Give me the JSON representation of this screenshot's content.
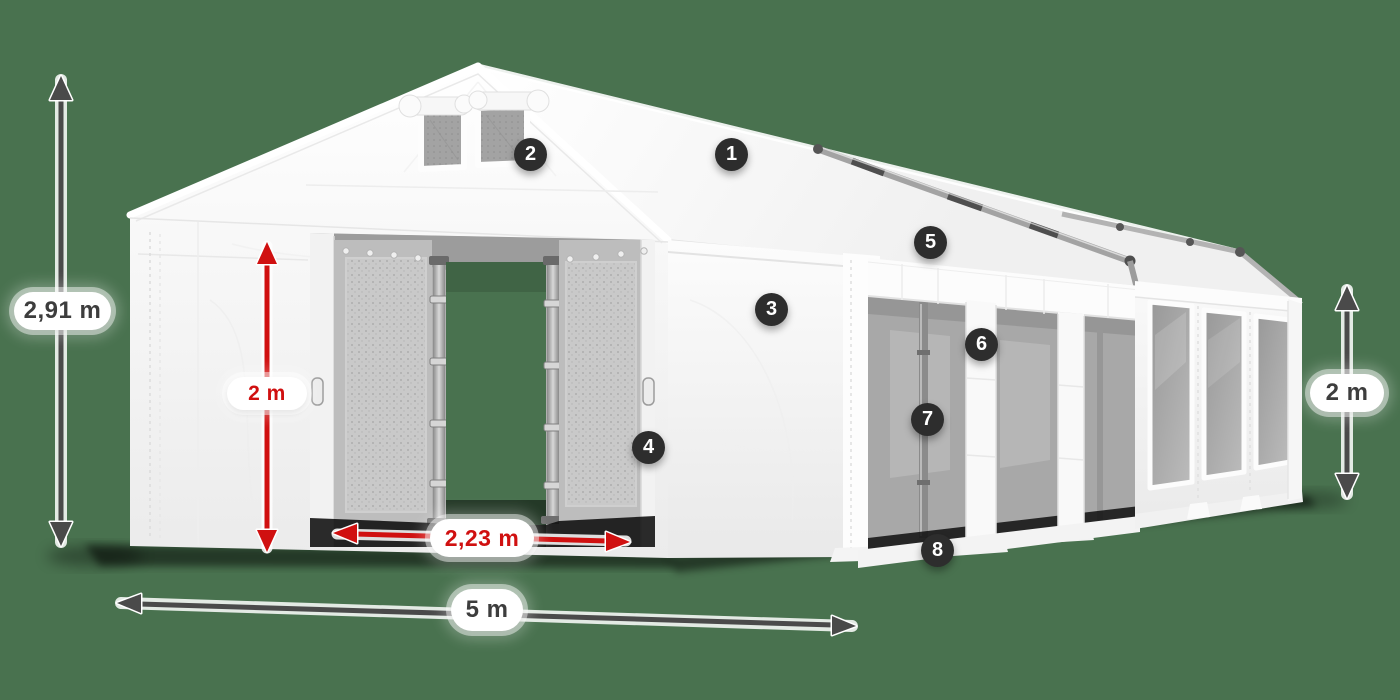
{
  "colors": {
    "background": "#49724f",
    "arrow_dark": "#4a4a4a",
    "arrow_red": "#d01010",
    "badge_background": "#2d2d2d",
    "badge_text": "#ffffff",
    "label_background": "#ffffff",
    "label_text_dark": "#3d3d3d",
    "label_text_red": "#d01010",
    "tent_white": "#f7f7f7"
  },
  "dimensions": {
    "total_height": {
      "text": "2,91 m"
    },
    "door_height": {
      "text": "2 m"
    },
    "door_width": {
      "text": "2,23 m"
    },
    "width": {
      "text": "5 m"
    },
    "side_height": {
      "text": "2 m"
    }
  },
  "callouts": [
    "1",
    "2",
    "3",
    "4",
    "5",
    "6",
    "7",
    "8"
  ]
}
